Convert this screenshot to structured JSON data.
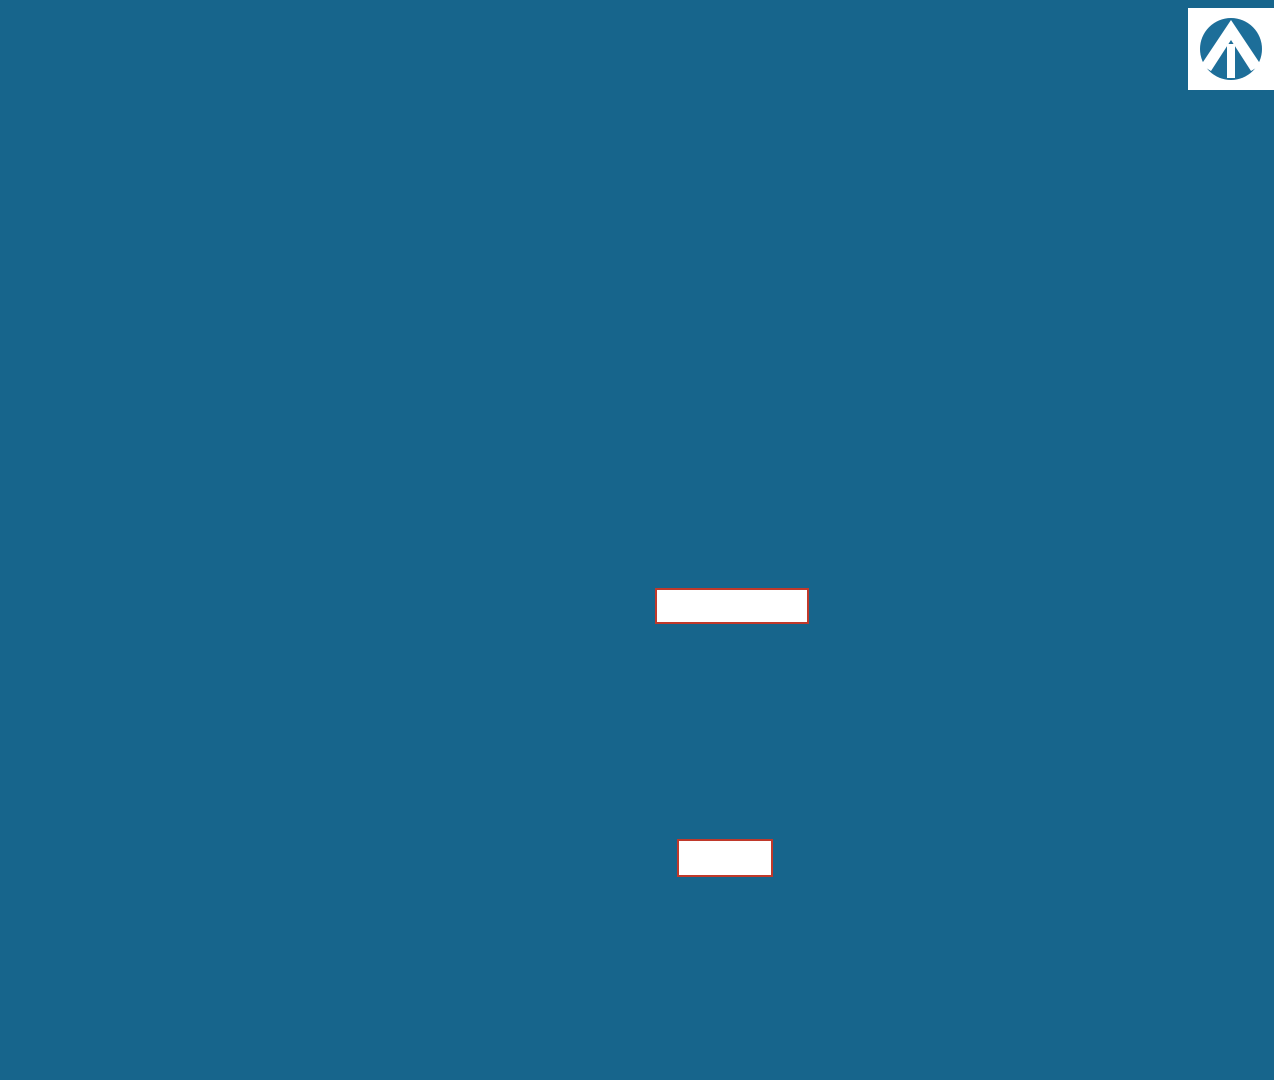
{
  "streets": [
    {
      "name": "SUMMERLEA BOULEVARD",
      "x": 620,
      "y": 27,
      "r": 0,
      "s": 13
    },
    {
      "name": "REDONDA STREET",
      "x": 57,
      "y": 420,
      "r": -90,
      "s": 12
    },
    {
      "name": "EMBERWELL STREET",
      "x": 413,
      "y": 383,
      "r": -90,
      "s": 12
    },
    {
      "name": "MOSAIC STREET",
      "x": 723,
      "y": 374,
      "r": -90,
      "s": 12.5
    },
    {
      "name": "DOVETAIL CRESCENT",
      "x": 858,
      "y": 232,
      "r": 0,
      "s": 12.5
    },
    {
      "name": "DOVETAIL CRESCENT",
      "x": 1023,
      "y": 383,
      "r": -90,
      "s": 11.5
    },
    {
      "name": "MIRAVALE AVENUE",
      "x": 888,
      "y": 575,
      "r": 0,
      "s": 12.5
    },
    {
      "name": "EMBERWELL STREET",
      "x": 757,
      "y": 890,
      "r": 0,
      "s": 12.5
    },
    {
      "name": "EMBERWELL STREET",
      "x": 1028,
      "y": 772,
      "r": -90,
      "s": 11.5
    },
    {
      "name": "PUBLIC RESERVE",
      "x": 1194,
      "y": 763,
      "r": -90,
      "s": 10.5
    },
    {
      "name": "LANE",
      "x": 305,
      "y": 208,
      "r": 0,
      "s": 10
    },
    {
      "name": "LANE",
      "x": 633,
      "y": 210,
      "r": 0,
      "s": 10
    },
    {
      "name": "LANE",
      "x": 246,
      "y": 441,
      "r": -90,
      "s": 9.5
    },
    {
      "name": "LANE",
      "x": 570,
      "y": 388,
      "r": -90,
      "s": 9.5
    },
    {
      "name": "LANE",
      "x": 733,
      "y": 737,
      "r": 0,
      "s": 10
    }
  ],
  "overlays": {
    "box1": {
      "parts": [
        "x",
        "H",
        "x"
      ]
    },
    "box2": {
      "text": "xx H xx"
    }
  },
  "block15": {
    "label": "BLOCK 15",
    "lot": "5",
    "dim": "265.7'",
    "he": "HE"
  },
  "block1_left": {
    "label": "BLOCK 1",
    "top": "103.33",
    "lots": [
      {
        "n": "12",
        "side": "100'",
        "sep": "119.75"
      },
      {
        "n": "13",
        "side": "100'",
        "sep": "119.75"
      },
      {
        "n": "14",
        "side": "100'",
        "sep": "114.82"
      },
      {
        "n": "15",
        "side": "100'",
        "sep": "132.39"
      },
      {
        "n": "16",
        "side": "107.4'",
        "sep": ""
      }
    ]
  },
  "block1_right": {
    "label": "BLOCK 1",
    "top": "105.61",
    "lots": [
      {
        "n": "11",
        "side": "100'",
        "sep": "122.21"
      },
      {
        "n": "10",
        "side": "100'",
        "sep": "122.21"
      },
      {
        "n": "9",
        "side": "91.7'",
        "sep": "122.21"
      }
    ]
  },
  "block1_small": {
    "sd": "SD",
    "numbers": [
      "8",
      "7",
      "6",
      "5",
      "4",
      "3",
      "2",
      "1"
    ],
    "widths": [
      "27.9'",
      "25.6'",
      "24.9'",
      "25'",
      "25'",
      "25'",
      "25'",
      "30.2'"
    ],
    "dims": [
      {
        "t": "122.21",
        "x": 342,
        "y": 541
      },
      {
        "t": "122.21",
        "x": 345,
        "y": 590
      },
      {
        "t": "121.70",
        "x": 348,
        "y": 639
      },
      {
        "t": "121.16",
        "x": 351,
        "y": 688
      },
      {
        "t": "101.41",
        "x": 358,
        "y": 714
      }
    ]
  },
  "block5": {
    "label": "BLOCK 5",
    "top": "93.91",
    "bottom": "102.66",
    "he": "HE",
    "lots": [
      {
        "n": "1",
        "side": "100'",
        "sep": "110.32"
      },
      {
        "n": "2",
        "side": "100'",
        "sep": "110.32"
      },
      {
        "n": "3",
        "side": "115.1'",
        "sep": ""
      }
    ]
  },
  "block4": {
    "label": "BLOCK 4",
    "garage": "G",
    "vdim": "113.40",
    "he_left": [
      "HE",
      "SD"
    ],
    "he_right": [
      "HE",
      "SD"
    ],
    "lots": [
      {
        "n": "20",
        "w": "42'",
        "top": "43.61",
        "bot": "34.74"
      },
      {
        "n": "19",
        "w": "28'",
        "top": "28.02",
        "bot": "28.02"
      },
      {
        "n": "18",
        "w": "25'",
        "top": "25.00",
        "bot": "25.00"
      },
      {
        "n": "17",
        "w": "25'",
        "top": "25.00",
        "bot": "25.00"
      },
      {
        "n": "16",
        "w": "25'",
        "top": "23.70",
        "bot": "25.00"
      },
      {
        "n": "15",
        "w": "25'",
        "top": "26.22",
        "bot": "25.00"
      },
      {
        "n": "14",
        "w": "25'",
        "top": "25.00",
        "bot": "25.00"
      },
      {
        "n": "13",
        "w": "25'",
        "top": "25.00",
        "bot": "25.00"
      },
      {
        "n": "12",
        "w": "25'",
        "top": "25.00",
        "bot": "25.00"
      },
      {
        "n": "11",
        "w": "25'",
        "top": "25.00",
        "bot": "25.00"
      },
      {
        "n": "10",
        "w": "25'",
        "top": "25.00",
        "bot": "25.00"
      },
      {
        "n": "9",
        "w": "25'",
        "top": "25.00",
        "bot": "25.00"
      },
      {
        "n": "8",
        "w": "25'",
        "top": "25.00",
        "bot": "25.00"
      },
      {
        "n": "7",
        "w": "25'",
        "top": "25.00",
        "bot": "25.00"
      },
      {
        "n": "6",
        "w": "25'",
        "top": "25.00",
        "bot": "25.00"
      },
      {
        "n": "5",
        "w": "25'",
        "top": "25.00",
        "bot": "25.00"
      },
      {
        "n": "4",
        "w": "25'",
        "top": "25.00",
        "bot": "25.00"
      },
      {
        "n": "3",
        "w": "25'",
        "top": "25.00",
        "bot": "25.00"
      },
      {
        "n": "2",
        "w": "28'",
        "top": "28.02",
        "bot": "28.02"
      },
      {
        "n": "1",
        "w": "28.1'",
        "top": "28.11",
        "bot": "28.18"
      }
    ]
  },
  "block3": {
    "label": "BLOCK 3",
    "garage": "G",
    "vdim": "110.12",
    "sd": "SD",
    "he_left": [
      "HE",
      "SD"
    ],
    "he_right": [
      "HE",
      "SD"
    ],
    "lots": [
      {
        "n": "18",
        "w": "30.4'",
        "top": "37.21",
        "bot": "29.95"
      },
      {
        "n": "17",
        "w": "28'",
        "top": "28.02",
        "bot": "28.02"
      },
      {
        "n": "16",
        "w": "28'",
        "top": "28.02",
        "bot": "28.02"
      },
      {
        "n": "15",
        "w": "28'",
        "top": "28.02",
        "bot": "28.02"
      },
      {
        "n": "14",
        "w": "28'",
        "top": "28.02",
        "bot": "28.02"
      },
      {
        "n": "13",
        "w": "28'",
        "top": "28.02",
        "bot": "28.02"
      },
      {
        "n": "12",
        "w": "28'",
        "top": "28.02",
        "bot": "28.02"
      },
      {
        "n": "11",
        "w": "28'",
        "top": "28.02",
        "bot": "28.02"
      },
      {
        "n": "10",
        "w": "28'",
        "top": "28.02",
        "bot": "28.02"
      },
      {
        "n": "9",
        "w": "28'",
        "top": "28.02",
        "bot": "28.02"
      },
      {
        "n": "8",
        "w": "28'",
        "top": "28.02",
        "bot": "28.02"
      },
      {
        "n": "7",
        "w": "28'",
        "top": "28.02",
        "bot": "28.02"
      },
      {
        "n": "6",
        "w": "28'",
        "top": "28.02",
        "bot": "28.02"
      },
      {
        "n": "5",
        "w": "28'",
        "top": "28.02",
        "bot": "28.02"
      },
      {
        "n": "4",
        "w": "28'",
        "top": "28.02",
        "bot": "28.02"
      },
      {
        "n": "3",
        "w": "28'",
        "top": "28.02",
        "bot": "28.02"
      },
      {
        "n": "2",
        "w": "28'",
        "top": "28.02",
        "bot": "28.02"
      },
      {
        "n": "1",
        "w": "30'",
        "top": "30.15",
        "bot": "30.02"
      }
    ]
  },
  "right_col": {
    "hx": [
      "HX",
      "SD"
    ],
    "top": "114.03",
    "lots": [
      {
        "n": "1",
        "w": "17.8'",
        "sep": "114.03"
      },
      {
        "n": "2",
        "w": "34'",
        "sep": "114.81"
      },
      {
        "n": "3",
        "w": "34'",
        "sep": "114.81"
      },
      {
        "n": "4",
        "w": "34'",
        "sep": "114.81"
      },
      {
        "n": "5",
        "w": "34'",
        "sep": "114.83"
      },
      {
        "n": "6",
        "w": "36'",
        "sep": "114.36"
      },
      {
        "n": "7",
        "w": "36'",
        "sep": "103.37"
      },
      {
        "n": "8",
        "w": "43.7'",
        "sep": ""
      }
    ]
  },
  "block2": {
    "label": "BLOCK 2",
    "hx": [
      "HX",
      "SD"
    ],
    "bottom_lots": [
      {
        "n": "27",
        "w": "35.2'",
        "top": "29.03",
        "bot": "47.52"
      },
      {
        "n": "26",
        "w": "32'",
        "top": "12.50",
        "bot": "32.02"
      },
      {
        "n": "25",
        "w": "32'",
        "top": "32.02",
        "bot": "32.02"
      },
      {
        "n": "24",
        "w": "34'",
        "top": "34.02",
        "bot": "34.02"
      },
      {
        "n": "23",
        "w": "34'",
        "top": "34.02",
        "bot": "34.02"
      },
      {
        "n": "22",
        "w": "34'",
        "top": "34.02",
        "bot": "34.02"
      },
      {
        "n": "21",
        "w": "34'",
        "top": "34.02",
        "bot": "34.02"
      },
      {
        "n": "20",
        "w": "32'",
        "top": "32.02",
        "bot": "32.02"
      },
      {
        "n": "19",
        "w": "32'",
        "top": "32.02",
        "bot": "32.02"
      },
      {
        "n": "18",
        "w": "34'",
        "top": "34.02",
        "bot": "34.02"
      },
      {
        "n": "17",
        "w": "34'",
        "top": "34.02",
        "bot": "34.02"
      },
      {
        "n": "16",
        "w": "34'",
        "top": "34.02",
        "bot": "34.02"
      },
      {
        "n": "15",
        "w": "32'",
        "top": "32.02",
        "bot": "32.02"
      },
      {
        "n": "14",
        "w": "32'",
        "top": "32.02",
        "bot": "32.02"
      },
      {
        "n": "13",
        "w": "32'",
        "top": "32.02",
        "bot": "32.02"
      },
      {
        "n": "12",
        "w": "34'",
        "top": "34.02",
        "bot": "34.02"
      },
      {
        "n": "11",
        "w": "50.7'",
        "top": "34.70",
        "bot": "34.02"
      }
    ],
    "left_lots": [
      {
        "n": "34",
        "w": "36'"
      },
      {
        "n": "33",
        "w": "36'"
      },
      {
        "n": "32",
        "w": "36'"
      },
      {
        "n": "31",
        "w": "42.5'"
      },
      {
        "n": "30",
        "w": "45.1'"
      },
      {
        "n": "29",
        "w": "45.1'"
      },
      {
        "n": "28",
        "w": "45.1'"
      }
    ],
    "angled": [
      {
        "n": "10",
        "w": "45.1'"
      },
      {
        "n": "9",
        "w": "45.1'"
      }
    ]
  },
  "extra_labels": [
    {
      "t": "103.33",
      "x": 174,
      "y": 219
    },
    {
      "t": "105.61",
      "x": 315,
      "y": 219
    },
    {
      "t": "119.75",
      "x": 174,
      "y": 319
    },
    {
      "t": "119.75",
      "x": 174,
      "y": 420
    },
    {
      "t": "114.82",
      "x": 174,
      "y": 517
    },
    {
      "t": "132.39",
      "x": 174,
      "y": 609
    },
    {
      "t": "122.21",
      "x": 315,
      "y": 317
    },
    {
      "t": "122.21",
      "x": 315,
      "y": 417
    },
    {
      "t": "122.21",
      "x": 315,
      "y": 517
    },
    {
      "t": "93.91",
      "x": 500,
      "y": 224
    },
    {
      "t": "110.32",
      "x": 500,
      "y": 327
    },
    {
      "t": "110.32",
      "x": 500,
      "y": 429
    },
    {
      "t": "102.66",
      "x": 498,
      "y": 530
    },
    {
      "t": "265.7'",
      "x": 247,
      "y": 161
    },
    {
      "t": "181.37",
      "x": 205,
      "y": 724,
      "r": 13
    },
    {
      "t": "114.32",
      "x": 948,
      "y": 898,
      "r": -12
    },
    {
      "t": "82.87",
      "x": 1052,
      "y": 1040
    },
    {
      "t": "83.53",
      "x": 1128,
      "y": 1040
    },
    {
      "t": "12.65",
      "x": 1162,
      "y": 988,
      "r": -75
    },
    {
      "t": "56.40",
      "x": 342,
      "y": 1032,
      "r": 8
    },
    {
      "t": "34.21",
      "x": 392,
      "y": 1044
    },
    {
      "t": "72.82",
      "x": 447,
      "y": 1044
    },
    {
      "t": "4.04",
      "x": 306,
      "y": 770,
      "r": -85
    },
    {
      "t": "26.93",
      "x": 304,
      "y": 800,
      "r": -85
    },
    {
      "t": "36.02",
      "x": 304,
      "y": 838,
      "r": -85
    },
    {
      "t": "43.09",
      "x": 304,
      "y": 876,
      "r": -85
    },
    {
      "t": "60.96",
      "x": 306,
      "y": 938,
      "r": -85
    },
    {
      "t": "7.63",
      "x": 308,
      "y": 1002,
      "r": -85
    },
    {
      "t": "137.73",
      "x": 382,
      "y": 750
    },
    {
      "t": "143.39",
      "x": 376,
      "y": 788
    },
    {
      "t": "124.67",
      "x": 371,
      "y": 824
    },
    {
      "t": "113.67",
      "x": 363,
      "y": 851
    },
    {
      "t": "123.69",
      "x": 362,
      "y": 895,
      "r": -12
    },
    {
      "t": "146.23",
      "x": 372,
      "y": 938,
      "r": -33
    },
    {
      "t": "HX",
      "x": 313,
      "y": 786
    },
    {
      "t": "SD",
      "x": 318,
      "y": 793
    },
    {
      "t": "HX",
      "x": 313,
      "y": 826
    },
    {
      "t": "SD",
      "x": 318,
      "y": 833
    },
    {
      "t": "HX",
      "x": 313,
      "y": 857
    },
    {
      "t": "SD",
      "x": 318,
      "y": 864
    },
    {
      "t": "HX",
      "x": 313,
      "y": 920
    },
    {
      "t": "SD",
      "x": 318,
      "y": 927
    },
    {
      "t": "HX",
      "x": 313,
      "y": 1003
    },
    {
      "t": "SD",
      "x": 318,
      "y": 1010
    },
    {
      "t": "HX",
      "x": 256,
      "y": 749
    },
    {
      "t": "SD",
      "x": 290,
      "y": 753
    },
    {
      "t": "HX",
      "x": 1152,
      "y": 922
    },
    {
      "t": "SD",
      "x": 1157,
      "y": 929
    },
    {
      "t": "HX",
      "x": 1088,
      "y": 1014
    },
    {
      "t": "SD",
      "x": 1093,
      "y": 1021
    },
    {
      "t": "HE",
      "x": 363,
      "y": 179
    },
    {
      "t": "HE",
      "x": 542,
      "y": 524
    },
    {
      "t": "HE",
      "x": 480,
      "y": 701
    },
    {
      "t": "SD",
      "x": 480,
      "y": 708
    },
    {
      "t": "HE",
      "x": 985,
      "y": 679
    },
    {
      "t": "SD",
      "x": 990,
      "y": 687
    },
    {
      "t": "HE",
      "x": 488,
      "y": 753
    },
    {
      "t": "SD",
      "x": 485,
      "y": 760
    },
    {
      "t": "HE",
      "x": 988,
      "y": 756
    },
    {
      "t": "SD",
      "x": 993,
      "y": 763
    }
  ],
  "trees": {
    "segments": [
      [
        24,
        88,
        24,
        1030,
        15
      ],
      [
        85,
        128,
        85,
        1030,
        14
      ],
      [
        152,
        62,
        388,
        60,
        6
      ],
      [
        482,
        62,
        705,
        63,
        6
      ],
      [
        388,
        112,
        388,
        560,
        8
      ],
      [
        432,
        118,
        432,
        560,
        8
      ],
      [
        695,
        80,
        695,
        540,
        8
      ],
      [
        753,
        95,
        753,
        540,
        8
      ],
      [
        775,
        200,
        1000,
        200,
        6
      ],
      [
        780,
        262,
        985,
        262,
        5
      ],
      [
        1008,
        300,
        1008,
        530,
        5
      ],
      [
        1052,
        310,
        1052,
        530,
        5
      ],
      [
        520,
        550,
        1160,
        549,
        12
      ],
      [
        488,
        592,
        1000,
        590,
        12
      ],
      [
        1050,
        590,
        1250,
        588,
        5
      ],
      [
        505,
        863,
        995,
        862,
        11
      ],
      [
        478,
        906,
        1000,
        904,
        12
      ],
      [
        1046,
        615,
        1046,
        878,
        6
      ]
    ],
    "singles": [
      [
        118,
        92
      ],
      [
        103,
        128
      ],
      [
        99,
        164
      ],
      [
        394,
        543
      ],
      [
        401,
        589
      ],
      [
        409,
        636
      ],
      [
        418,
        683
      ],
      [
        430,
        722
      ],
      [
        442,
        757
      ],
      [
        447,
        797
      ],
      [
        452,
        838
      ],
      [
        458,
        880
      ],
      [
        1030,
        207
      ],
      [
        1050,
        226
      ],
      [
        1062,
        250
      ],
      [
        1066,
        282
      ],
      [
        1000,
        790
      ],
      [
        1003,
        835
      ],
      [
        1010,
        872
      ],
      [
        1025,
        890
      ]
    ],
    "big": [
      [
        890,
        48
      ],
      [
        928,
        40
      ],
      [
        1040,
        26
      ],
      [
        1100,
        16
      ],
      [
        1148,
        56
      ],
      [
        1222,
        110
      ],
      [
        1219,
        148
      ],
      [
        1228,
        398
      ],
      [
        1233,
        434
      ],
      [
        1250,
        472
      ],
      [
        1243,
        506
      ],
      [
        1220,
        542
      ]
    ],
    "bushes": [
      [
        1197,
        440
      ],
      [
        1198,
        456
      ],
      [
        1197,
        472
      ],
      [
        1196,
        486
      ]
    ]
  },
  "colors": {
    "frame": "#17658C",
    "frame_band": "#1A7CAD",
    "road": "#D9DADB",
    "verge": "#C6E3B5",
    "tan": "#D1A77B",
    "orange": "#F8BF68",
    "cream": "#FBF7DF",
    "red": "#C8502F",
    "garage_letter": "#7E2D1B",
    "tree": "#4E9C59",
    "tree_big": "#7FC46F",
    "text": "#161616",
    "blue_note": "#2936C6",
    "logo_blue": "#1D6E99"
  }
}
